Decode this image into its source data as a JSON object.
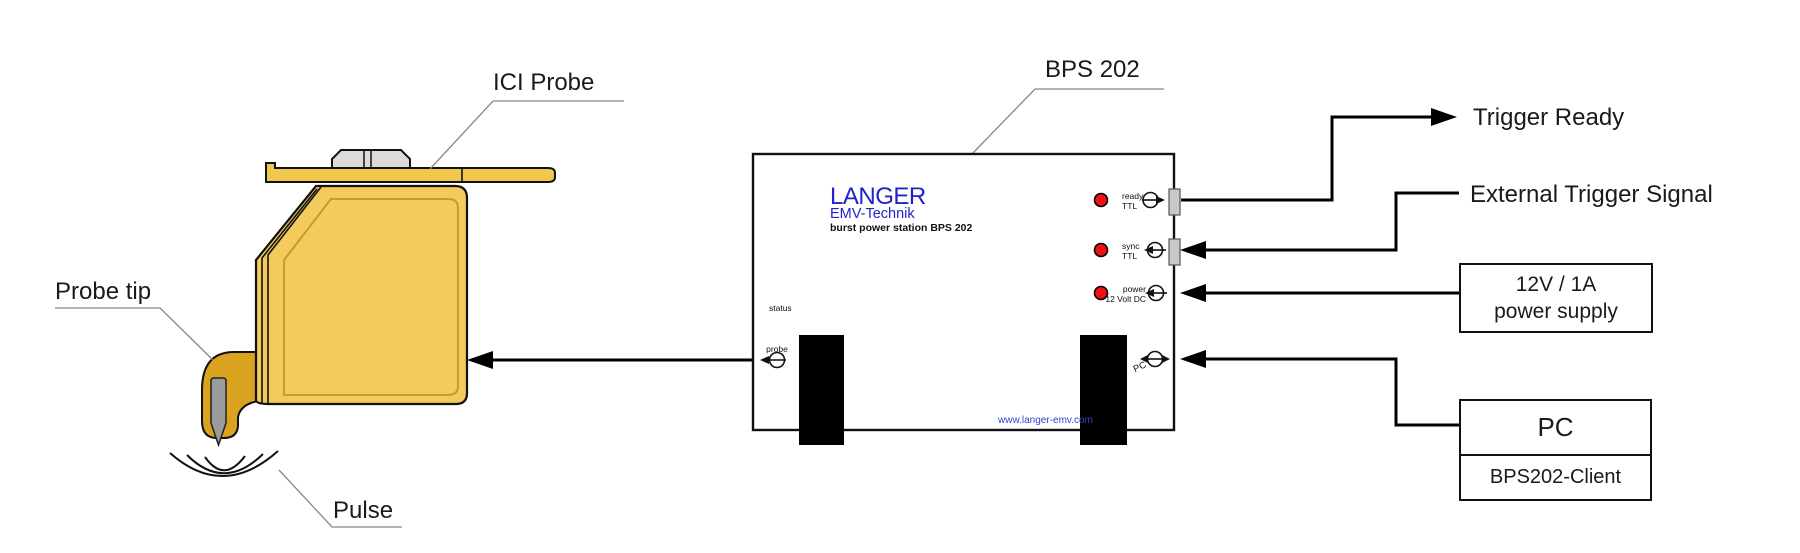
{
  "labels": {
    "ici_probe": "ICI Probe",
    "probe_tip": "Probe tip",
    "pulse": "Pulse",
    "bps202": "BPS 202",
    "trigger_ready": "Trigger Ready",
    "external_trigger_signal": "External Trigger Signal"
  },
  "device": {
    "brand": "LANGER",
    "brand_sub": "EMV-Technik",
    "model_line": "burst power station BPS 202",
    "website": "www.langer-emv.com",
    "ports": {
      "status": "status",
      "probe": "probe",
      "ready": {
        "l1": "ready",
        "l2": "TTL"
      },
      "sync": {
        "l1": "sync",
        "l2": "TTL"
      },
      "power": {
        "l1": "power",
        "l2": "12 Volt DC"
      },
      "pc": "PC"
    }
  },
  "boxes": {
    "power_supply": {
      "line1": "12V / 1A",
      "line2": "power supply"
    },
    "pc": {
      "title": "PC",
      "subtitle": "BPS202-Client"
    }
  },
  "icons": {
    "ready_port": "circle-arrow-out-right-icon",
    "sync_port": "circle-arrow-in-left-icon",
    "power_port": "circle-arrow-in-left-icon",
    "pc_port": "circle-arrow-bidirectional-icon",
    "probe_port": "circle-arrow-out-left-icon"
  },
  "colors": {
    "brand_blue": "#2222CC",
    "website_blue": "#3344CC",
    "led_red": "#EE1111",
    "probe_body_yellow": "#F3CA5C",
    "probe_hook_gold": "#D9A21F",
    "probe_plate_yellow": "#F2C74E",
    "pin_gray": "#9B9B9B",
    "connector_gray": "#C8C8C8",
    "line_black": "#000000",
    "leader_gray": "#888888"
  }
}
